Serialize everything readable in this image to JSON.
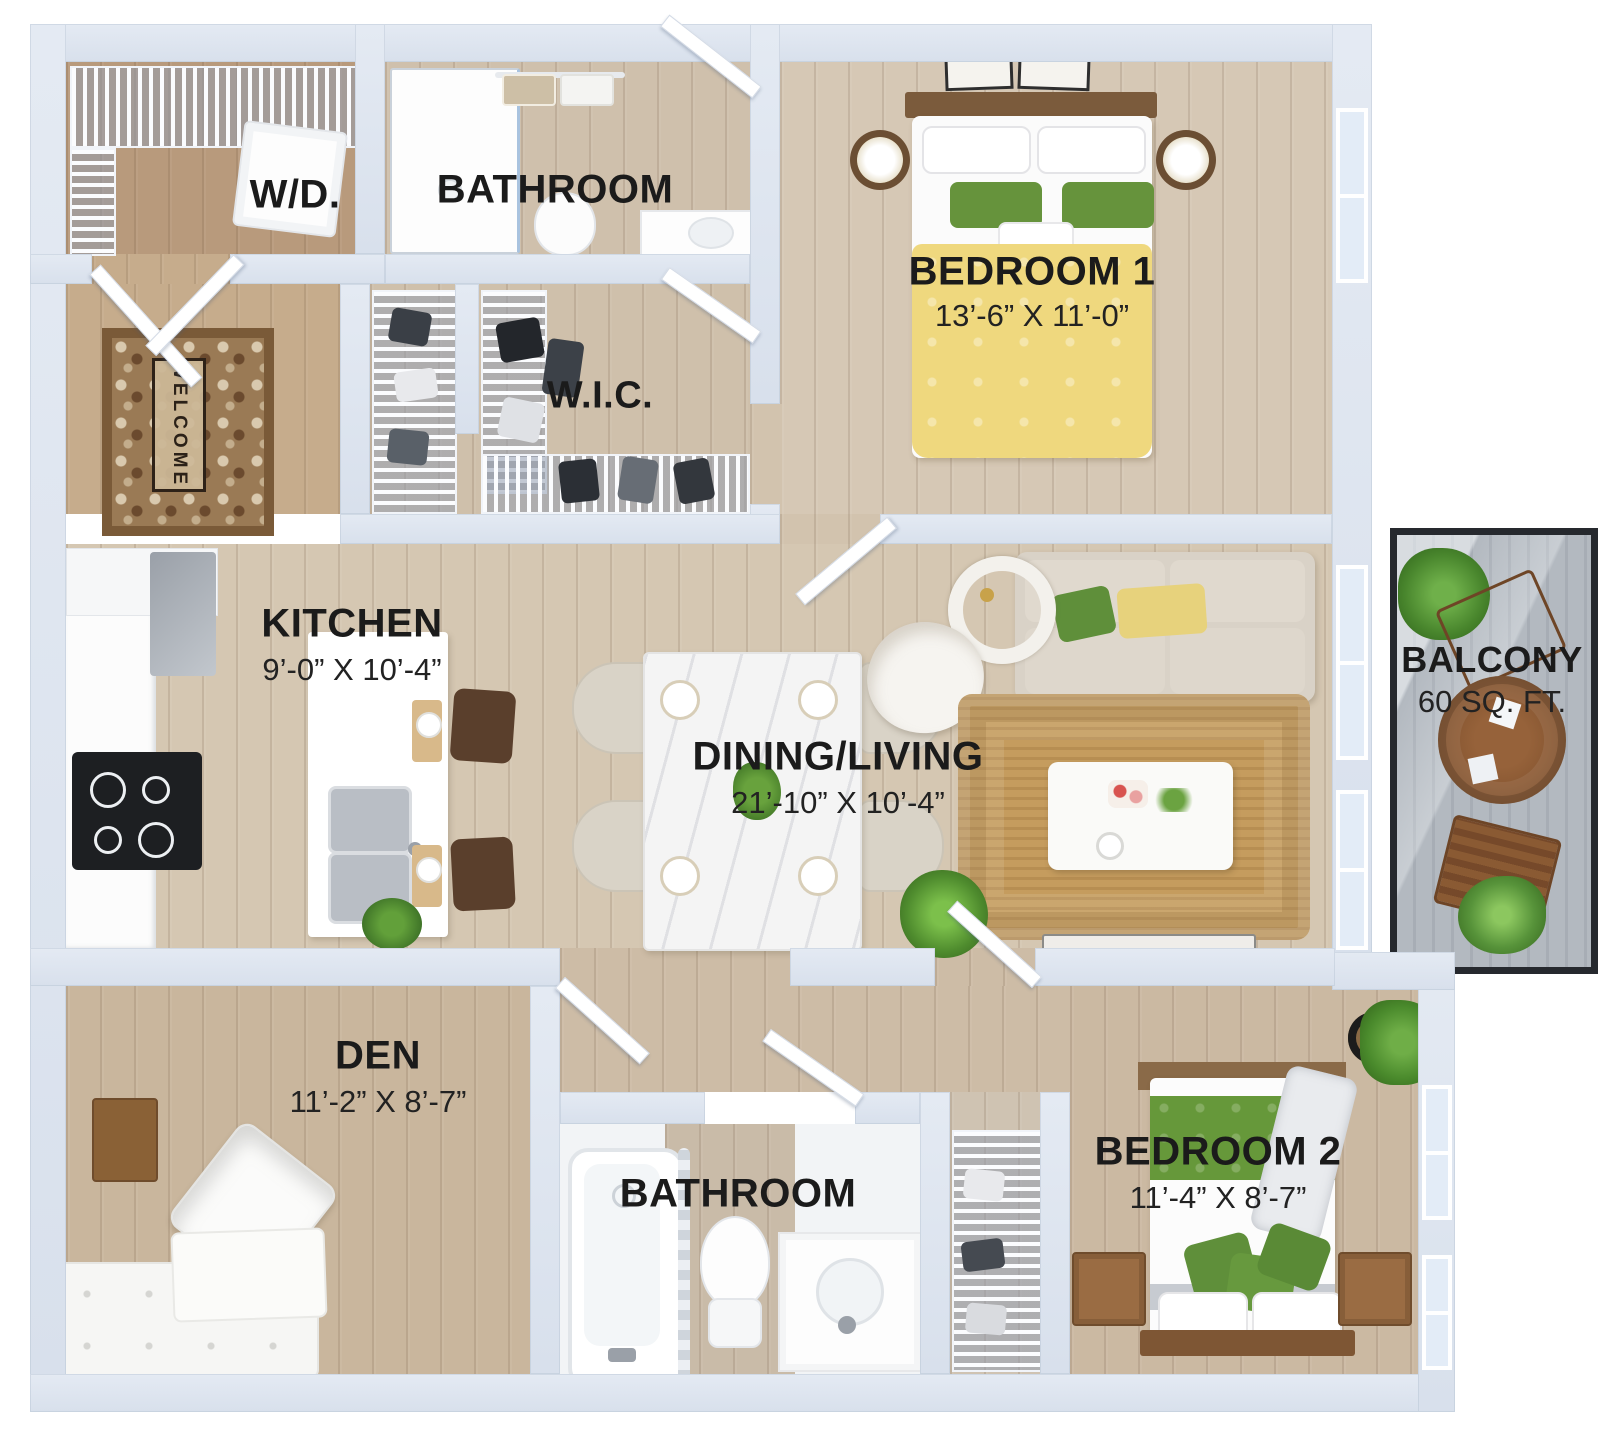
{
  "palette": {
    "wall": "#dde4ef",
    "floor_wood": "#d3c3ae",
    "accent_yellow": "#efd87e",
    "accent_green": "#66933c",
    "rug_jute": "#c59c5e",
    "balcony_deck": "#b3b9c0",
    "label_text": "#1b1b1b"
  },
  "rooms": {
    "wd": {
      "label": "W/D."
    },
    "bathroom_top": {
      "label": "BATHROOM"
    },
    "bedroom1": {
      "label": "BEDROOM 1",
      "dims": "13’-6” X 11’-0”"
    },
    "wic": {
      "label": "W.I.C."
    },
    "kitchen": {
      "label": "KITCHEN",
      "dims": "9’-0” X 10’-4”"
    },
    "dining_living": {
      "label": "DINING/LIVING",
      "dims": "21’-10” X 10’-4”"
    },
    "balcony": {
      "label": "BALCONY",
      "dims": "60 SQ. FT."
    },
    "den": {
      "label": "DEN",
      "dims": "11’-2” X 8’-7”"
    },
    "bathroom_bottom": {
      "label": "BATHROOM"
    },
    "bedroom2": {
      "label": "BEDROOM 2",
      "dims": "11’-4” X 8’-7”"
    }
  },
  "entry": {
    "mat_text": "WELCOME"
  }
}
